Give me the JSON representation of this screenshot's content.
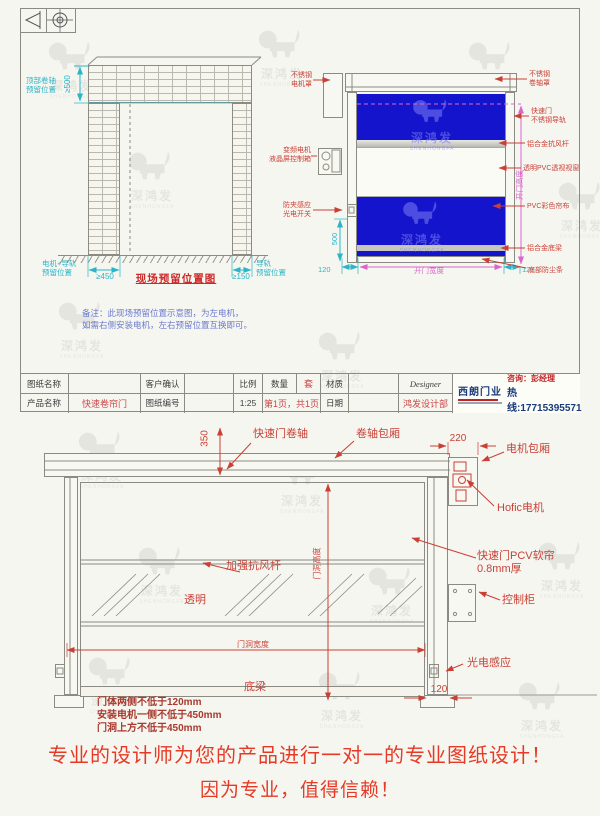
{
  "brand": {
    "name_cn": "深鸿发",
    "name_en": "SHENHONGFA"
  },
  "sheet1": {
    "site": {
      "top_label": "顶部卷轴\n预留位置",
      "top_dim": "≥500",
      "left_label": "电机+导轨\n预留位置",
      "left_dim": "≥450",
      "title": "现场预留位置图",
      "right_dim": "≥150",
      "right_label": "导轨\n预留位置",
      "note": "备注：此现场预留位置示意图，为左电机，\n如需右侧安装电机，左右预留位置互换即可。"
    },
    "door": {
      "motor_cover": "不锈钢\n电机罩",
      "motor": "变频电机\n液晶屏控制箱",
      "sensor": "防夹感应\n光电开关",
      "roller_cover": "不锈钢\n卷轴罩",
      "track": "快速门\n不锈钢导轨",
      "wind_bar": "铝合金抗风杆",
      "window": "透明PVC透视视窗",
      "curtain": "PVC彩色帘布",
      "bottom_beam": "铝合金底梁",
      "bottom_seal": "底部防尘条",
      "dim_sensor_h": "500",
      "dim_120_left": "120",
      "dim_width": "开门宽度",
      "dim_120_right": "120",
      "dim_height": "开门高度"
    },
    "titleblock": {
      "drawing_name_label": "图纸名称",
      "customer_label": "客户确认",
      "scale_label": "比例",
      "qty_label": "数量",
      "qty_value": "套",
      "material_label": "材质",
      "designer_label": "Designer",
      "product_label": "产品名称",
      "product_value": "快速卷帘门",
      "drawing_no_label": "图纸编号",
      "scale_value": "1:25",
      "page_value": "第1页，共1页",
      "date_label": "日期",
      "dept_value": "鸿发设计部",
      "logo_name": "西朗门业",
      "contact_person": "咨询：彭经理",
      "hotline": "热线:17715395571"
    }
  },
  "sheet2": {
    "dim_350": "350",
    "roller": "快速门卷轴",
    "roller_box": "卷轴包厢",
    "dim_220": "220",
    "motor_box": "电机包厢",
    "motor": "Hofic电机",
    "curtain": "快速门PCV软帘\n0.8mm厚",
    "wind_bar": "加强抗风杆",
    "transparent": "透明",
    "dim_width": "门洞宽度",
    "dim_height": "门洞高度",
    "control": "控制柜",
    "photo_sensor": "光电感应",
    "bottom_beam": "底梁",
    "dim_120": "120",
    "notes": "门体两侧不低于120mm\n安装电机一侧不低于450mm\n门洞上方不低于450mm",
    "slogan1": "专业的设计师为您的产品进行一对一的专业图纸设计！",
    "slogan2": "因为专业，值得信赖！"
  }
}
